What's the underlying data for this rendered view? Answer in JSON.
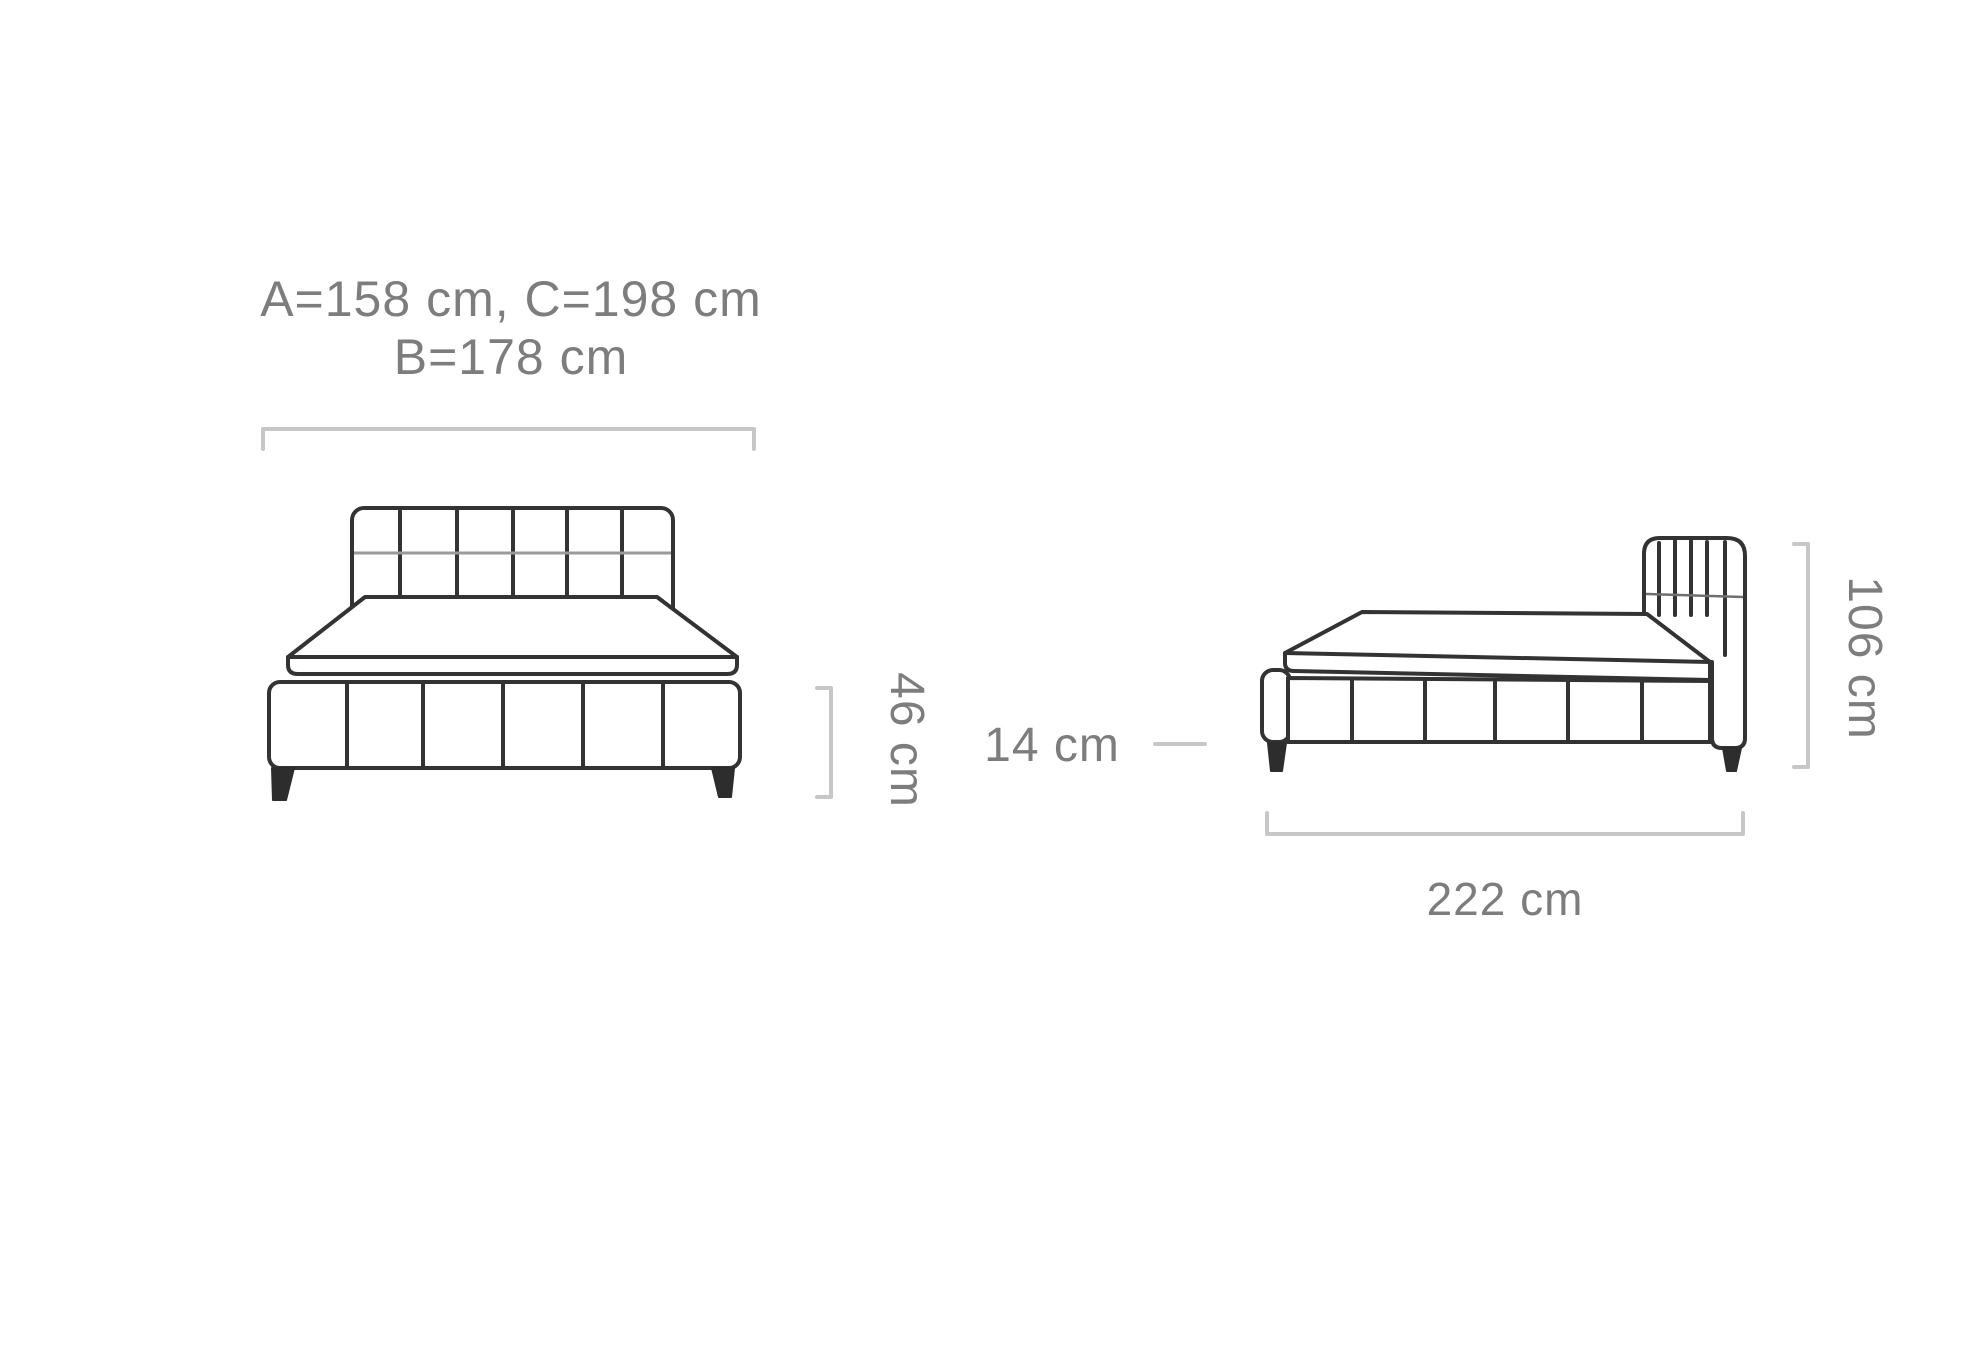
{
  "page": {
    "background": "#ffffff",
    "description": "Bed dimensions technical drawing, front view and side view"
  },
  "colors": {
    "bed_outline": "#333333",
    "dimension_line": "#c7c7c7",
    "label_text": "#7d7d7d",
    "seam_light": "#9a9a9a"
  },
  "front_view": {
    "width_label_line1": "A=158 cm, C=198 cm",
    "width_label_line2": "B=178 cm",
    "base_height_label": "46 cm",
    "leg_height_label": "14 cm"
  },
  "side_view": {
    "length_label": "222 cm",
    "height_label": "106 cm"
  }
}
